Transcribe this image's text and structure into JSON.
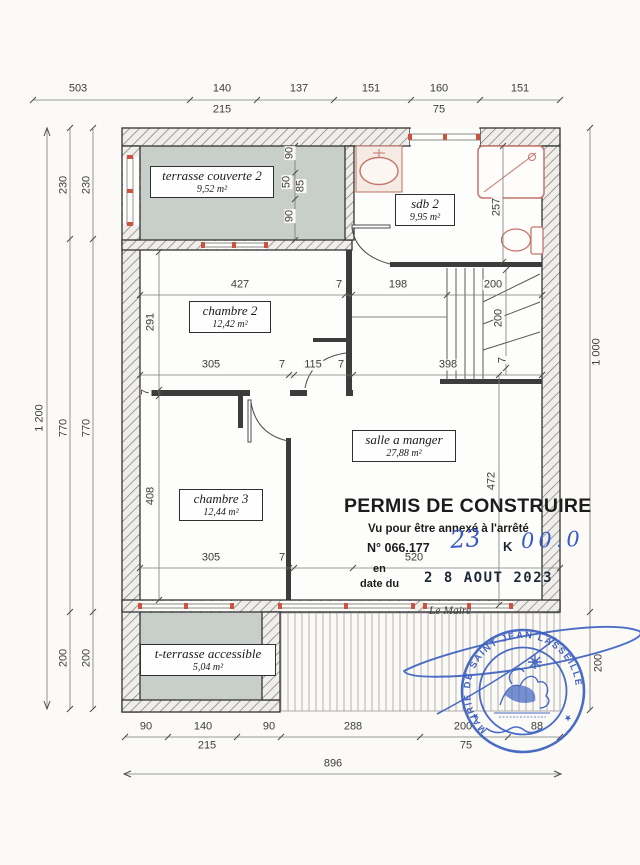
{
  "title_block": {
    "permit_title": "PERMIS DE CONSTRUIRE",
    "annex_note": "Vu pour être annexé à l'arrêté",
    "permit_number": "N° 066.177",
    "handwritten_ref_1": "23",
    "handwritten_ref_2": "K",
    "handwritten_ref_3": "00.0",
    "en_label": "en",
    "date_du_label": "date du",
    "date_stamp": "2 8 AOUT 2023",
    "signatory": "Le Maire"
  },
  "stamp": {
    "ring_text": "MAIRIE DE SAINT JEAN LASSEILLE",
    "ink_color": "#3356b8"
  },
  "rooms": [
    {
      "name": "terrasse couverte 2",
      "area": "9,52 m²"
    },
    {
      "name": "sdb 2",
      "area": "9,95 m²"
    },
    {
      "name": "chambre 2",
      "area": "12,42 m²"
    },
    {
      "name": "salle a manger",
      "area": "27,88 m²"
    },
    {
      "name": "chambre 3",
      "area": "12,44 m²"
    },
    {
      "name": "t-terrasse accessible",
      "area": "5,04 m²"
    }
  ],
  "dimensions": {
    "top_row1": [
      "503",
      "140",
      "137",
      "151",
      "160",
      "151"
    ],
    "top_row2": [
      "215",
      "75"
    ],
    "left_total": "1 200",
    "left_inner": [
      "230",
      "770",
      "200"
    ],
    "left_inner2": [
      "230",
      "770",
      "200"
    ],
    "right_total": "1 000",
    "right_lower": "200",
    "bottom_row1": [
      "90",
      "140",
      "90",
      "288",
      "200",
      "88"
    ],
    "bottom_row2": [
      "215",
      "75"
    ],
    "bottom_total": "896",
    "interior": {
      "chambre2_top": "427",
      "wall_top": "7",
      "hall_width": "198",
      "stairs_width": "200",
      "chambre2_left": "291",
      "chambre2_bottom": "305",
      "w1": "7",
      "door": "115",
      "w2": "7",
      "hall_bottom": "398",
      "stairs_height": "200",
      "w3": "7",
      "wall_left": "7",
      "chambre3_left": "408",
      "salle_height": "472",
      "chambre3_bottom": "305",
      "w4": "7",
      "salle_bottom": "520",
      "t1": "90",
      "t2": "50",
      "t3": "85",
      "t4": "90",
      "sdb_depth": "257"
    }
  }
}
